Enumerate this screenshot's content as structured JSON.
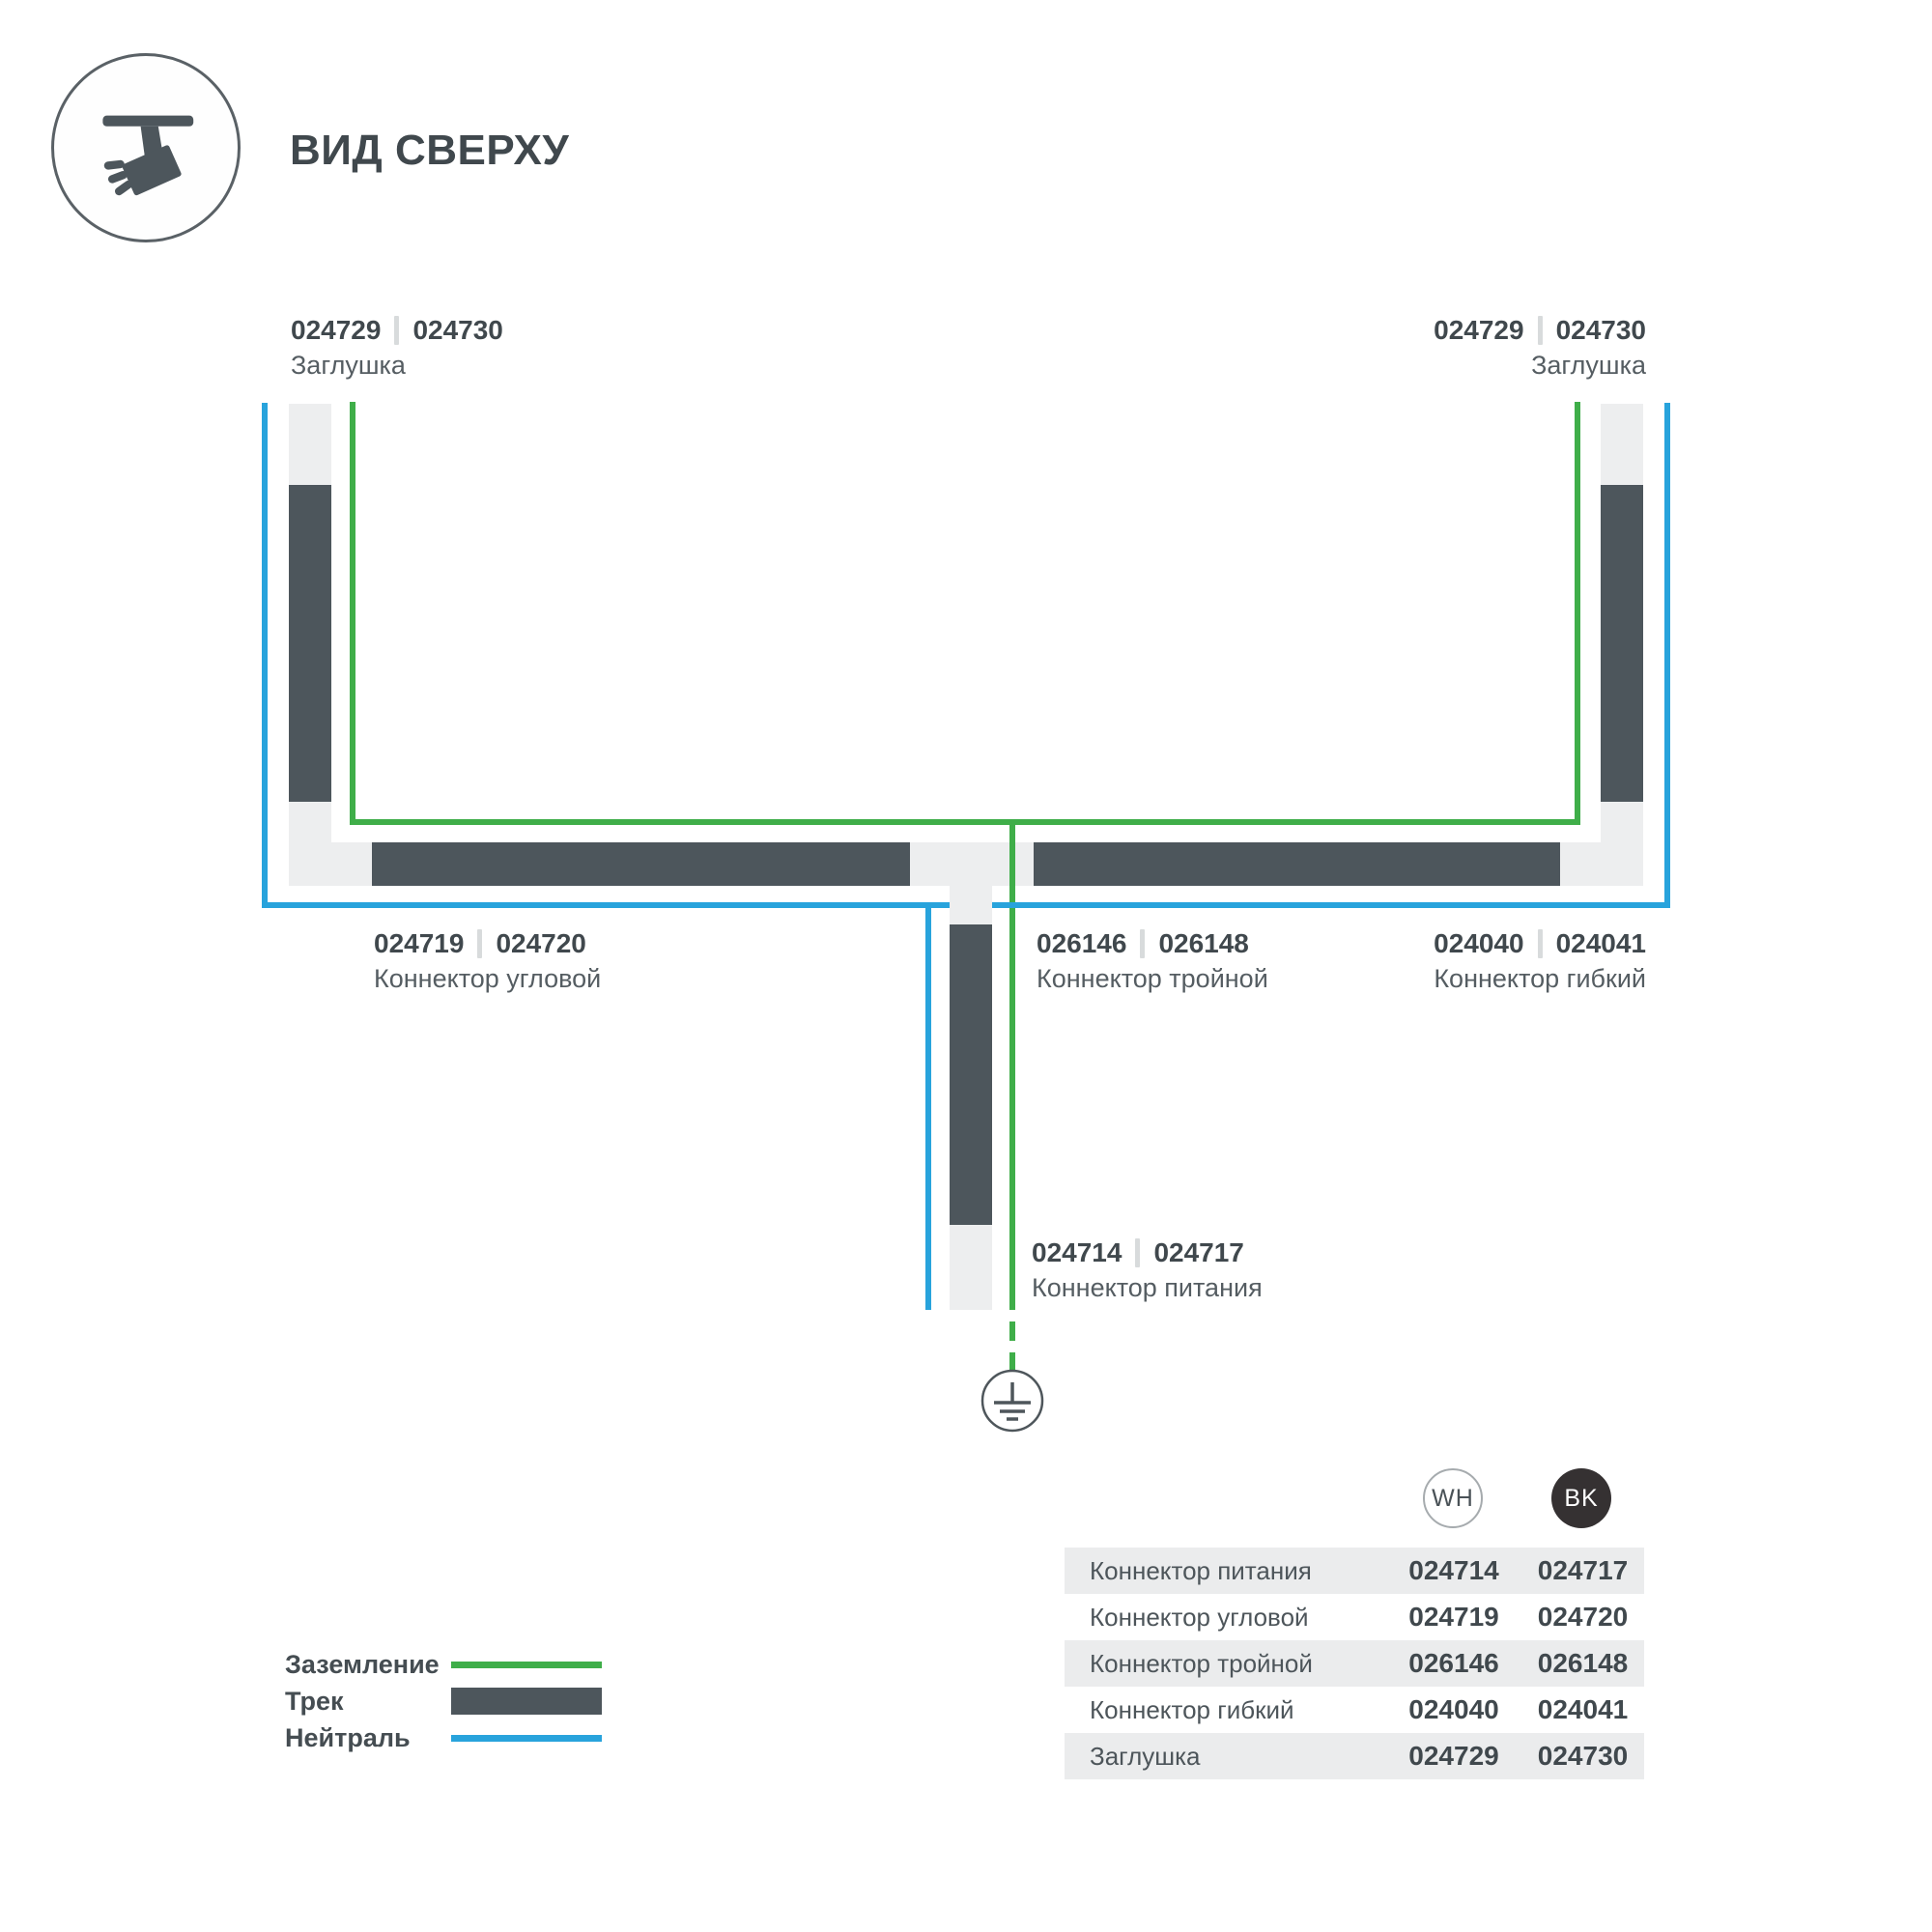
{
  "header": {
    "title": "ВИД СВЕРХУ"
  },
  "colors": {
    "ground": "#3fae49",
    "neutral": "#28a3dc",
    "track": "#4d565c",
    "track_light": "#edeeef",
    "text_dark": "#40484d",
    "text_regular": "#555d62",
    "row_stripe": "#ebeced",
    "bk_fill": "#353132"
  },
  "diagram": {
    "endcap_left": {
      "code_wh": "024729",
      "code_bk": "024730",
      "name": "Заглушка"
    },
    "endcap_right": {
      "code_wh": "024729",
      "code_bk": "024730",
      "name": "Заглушка"
    },
    "corner": {
      "code_wh": "024719",
      "code_bk": "024720",
      "name": "Коннектор угловой"
    },
    "triple": {
      "code_wh": "026146",
      "code_bk": "026148",
      "name": "Коннектор тройной"
    },
    "flexible": {
      "code_wh": "024040",
      "code_bk": "024041",
      "name": "Коннектор гибкий"
    },
    "power": {
      "code_wh": "024714",
      "code_bk": "024717",
      "name": "Коннектор питания"
    }
  },
  "legend": {
    "items": [
      {
        "label": "Заземление",
        "color_key": "ground"
      },
      {
        "label": "Трек",
        "color_key": "track"
      },
      {
        "label": "Нейтраль",
        "color_key": "neutral"
      }
    ]
  },
  "table": {
    "columns": [
      {
        "label": "WH"
      },
      {
        "label": "BK"
      }
    ],
    "rows": [
      {
        "name": "Коннектор питания",
        "wh": "024714",
        "bk": "024717"
      },
      {
        "name": "Коннектор угловой",
        "wh": "024719",
        "bk": "024720"
      },
      {
        "name": "Коннектор тройной",
        "wh": "026146",
        "bk": "026148"
      },
      {
        "name": "Коннектор гибкий",
        "wh": "024040",
        "bk": "024041"
      },
      {
        "name": "Заглушка",
        "wh": "024729",
        "bk": "024730"
      }
    ]
  }
}
